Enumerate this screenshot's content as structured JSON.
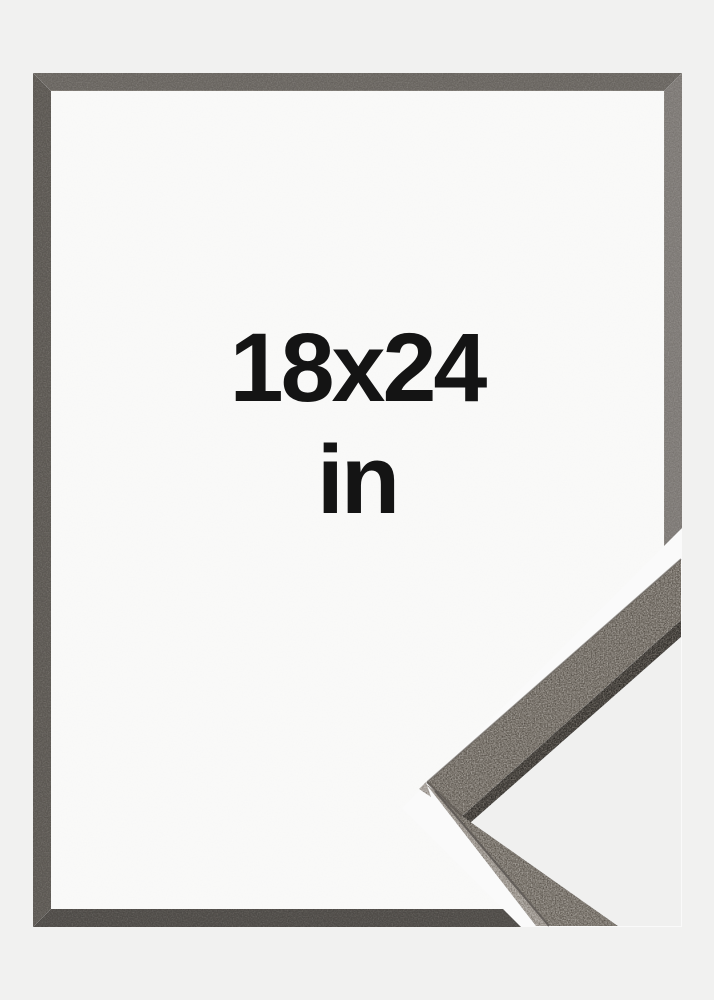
{
  "label": {
    "size": "18x24",
    "unit": "in"
  },
  "colors": {
    "background": "#f1f1f0",
    "inner_area": "#f9f9f8",
    "cutout_band": "#fafafa",
    "corner_gap": "#f0f0ef",
    "frame_top": "#6e6a65",
    "frame_left": "#615d58",
    "frame_right": "#827e7a",
    "frame_bottom": "#53504c",
    "corner_upper_face": "#7b756d",
    "corner_lower_face": "#7e7870",
    "corner_dark_edge": "#494540",
    "corner_light_edge": "#a19b94",
    "corner_apex_facet": "#aaa49e",
    "text": "#141414"
  }
}
